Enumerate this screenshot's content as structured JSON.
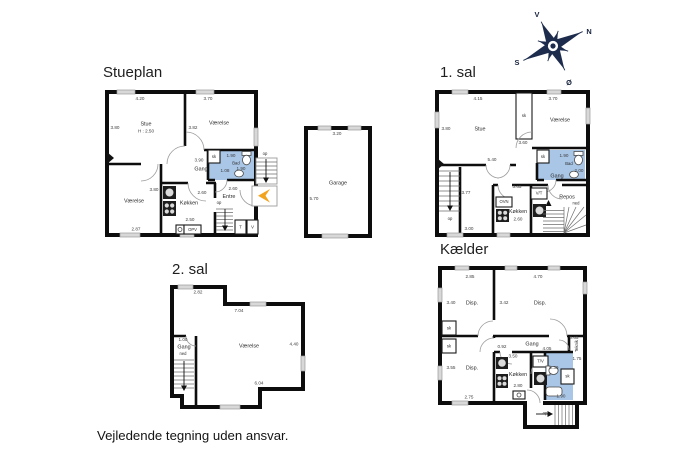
{
  "page": {
    "disclaimer": "Vejledende tegning uden ansvar."
  },
  "colors": {
    "bathroom": "#a9c6e6",
    "entrance_arrow": "#f2a41f",
    "compass": "#1d2c4d",
    "wall": "#111111"
  },
  "compass": {
    "v": "V",
    "n": "N",
    "s": "S",
    "oe": "Ø"
  },
  "stueplan": {
    "title": "Stueplan",
    "labels": {
      "stue": "Stue",
      "stue_h": "H : 2.50",
      "vaerelse_top": "Værelse",
      "vaerelse_bottom": "Værelse",
      "gang": "Gang",
      "koekken": "Køkken",
      "entre": "Entre",
      "bad": "Bad",
      "sk": "sk",
      "opv": "OPV",
      "t": "T",
      "v": "V",
      "op_stairs": "op",
      "op_entre": "op"
    },
    "dims": {
      "stue_w": "4.20",
      "vaerelse_w": "3.70",
      "stue_d": "3.80",
      "vaerelse_d": "3.82",
      "gang_w": "3.90",
      "gang_d": "1.08",
      "bad_w": "1.90",
      "bad_d": "1.90",
      "entre_w": "2.60",
      "koekken_w": "2.60",
      "koekken_d": "2.50",
      "koekken_side": "3.80",
      "vaerelse2_w": "2.87"
    }
  },
  "garage": {
    "labels": {
      "name": "Garage"
    },
    "dims": {
      "w": "3.20",
      "d": "5.70"
    }
  },
  "sal1": {
    "title": "1. sal",
    "labels": {
      "stue": "Stue",
      "vaerelse": "Værelse",
      "sk_closet": "sk",
      "sk_bad": "sk",
      "bad": "Bad",
      "gang": "Gang",
      "ovn": "OVN",
      "vt": "V/T",
      "koekken": "Køkken",
      "repos": "Repos",
      "ned": "ned",
      "op": "op"
    },
    "dims": {
      "stue_w": "4.15",
      "vaerelse_w": "3.70",
      "stue_d": "3.80",
      "mid_d": "3.60",
      "gang_w": "5.40",
      "stair_d": "3.77",
      "bad_w": "1.90",
      "bad_d": "2.00",
      "koekken_top": "3.65",
      "koekken_w": "2.60",
      "bottom_w": "3.00"
    }
  },
  "sal2": {
    "title": "2. sal",
    "labels": {
      "vaerelse": "Værelse",
      "gang": "Gang",
      "ned": "ned"
    },
    "dims": {
      "top_narrow": "2.82",
      "top_wide": "7.04",
      "right_d": "4.40",
      "bottom_w": "6.04",
      "gang_w": "1.00"
    }
  },
  "kaelder": {
    "title": "Kælder",
    "labels": {
      "disp1": "Disp.",
      "disp2": "Disp.",
      "disp3": "Disp.",
      "gang": "Gang",
      "koekken": "Køkken",
      "teknik": "Teknik",
      "tv": "T/V",
      "sk1": "sk",
      "sk2": "sk",
      "sk_bad": "sk",
      "op": "op"
    },
    "dims": {
      "room1_w": "2.85",
      "room2_w": "4.70",
      "room1_d": "3.40",
      "room2_d": "3.42",
      "gang_seg": "0.92",
      "gang_w": "4.05",
      "teknik_w": "0.65",
      "teknik_d": "1.75",
      "koekken_top": "3.50",
      "bad_w": "2.39",
      "disp3_d": "3.55",
      "koekken_w": "2.80",
      "disp3_w": "2.75",
      "bad_bottom": "1.90"
    }
  }
}
